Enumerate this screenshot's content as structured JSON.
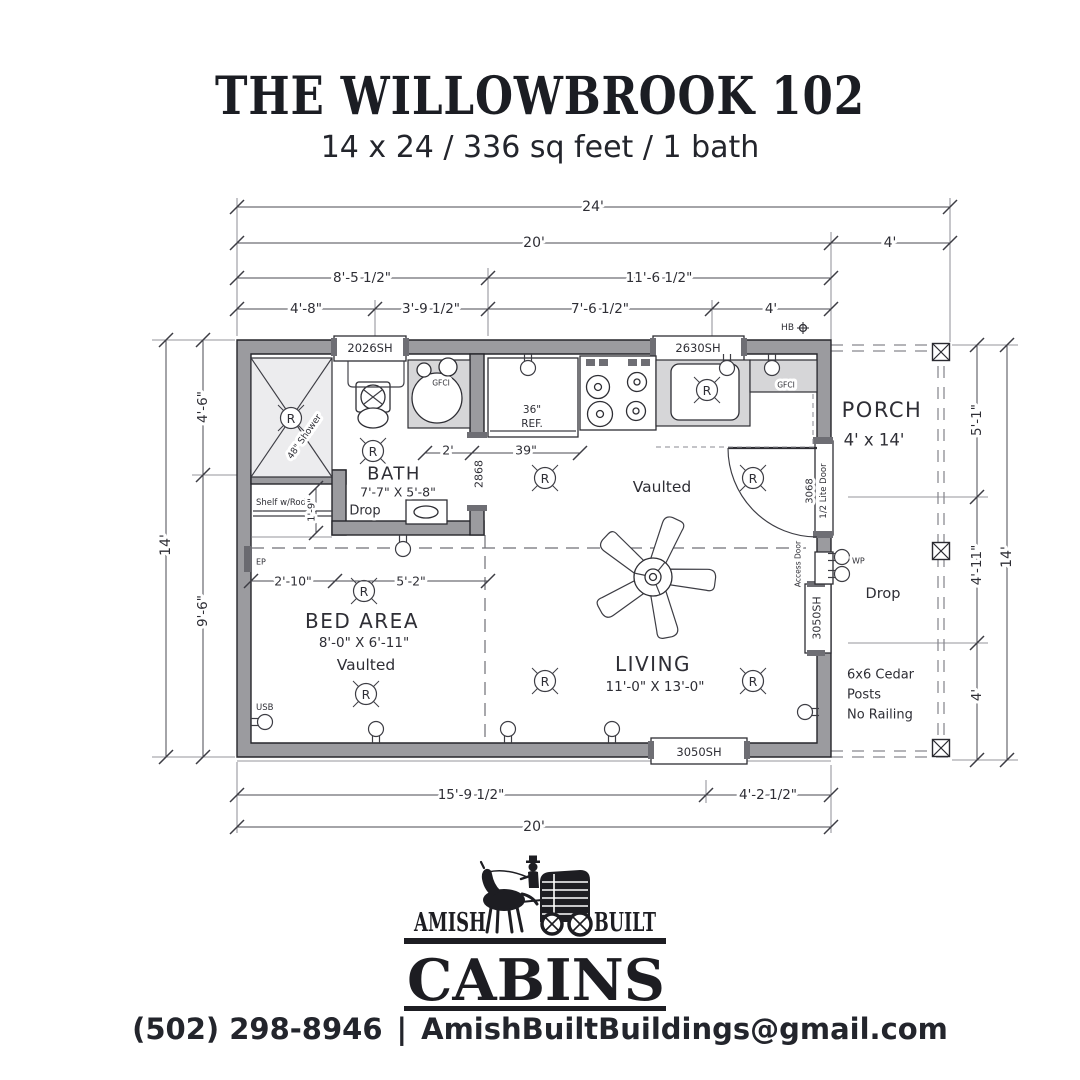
{
  "title": {
    "main": "THE WILLOWBROOK 102",
    "subtitle": "14 x 24 / 336 sq feet / 1 bath"
  },
  "plan": {
    "dims": {
      "w24": "24'",
      "w20": "20'",
      "w4": "4'",
      "w8_5": "8'-5 1/2\"",
      "w11_6": "11'-6 1/2\"",
      "w4_8": "4'-8\"",
      "w3_9": "3'-9 1/2\"",
      "w7_6": "7'-6 1/2\"",
      "w4b": "4'",
      "h4_6": "4'-6\"",
      "h14": "14'",
      "h9_6": "9'-6\"",
      "p5_1": "5'-1\"",
      "p4_11": "4'-11\"",
      "p4": "4'",
      "p14": "14'",
      "b15_9": "15'-9 1/2\"",
      "b4_2": "4'-2 1/2\"",
      "b20": "20'",
      "d2": "2'",
      "d39": "39\"",
      "d1_9": "1'-9\"",
      "d2_10": "2'-10\"",
      "d5_2": "5'-2\""
    },
    "openings": {
      "w2026": "2026SH",
      "w2630": "2630SH",
      "w3050_bottom": "3050SH",
      "w3050_side": "3050SH",
      "d2868": "2868",
      "d3068": "3068",
      "d3068_type": "1/2 Lite Door",
      "access": "Access Door"
    },
    "rooms": {
      "bath": {
        "name": "BATH",
        "size": "7'-7\" X 5'-8\"",
        "note": "Drop"
      },
      "bed": {
        "name": "BED AREA",
        "size": "8'-0\" X 6'-11\"",
        "note": "Vaulted"
      },
      "living": {
        "name": "LIVING",
        "size": "11'-0\" X 13'-0\""
      },
      "kitchen": {
        "note": "Vaulted"
      },
      "porch": {
        "name": "PORCH",
        "size": "4' x 14'",
        "note": "Drop",
        "posts_line1": "6x6 Cedar",
        "posts_line2": "Posts",
        "posts_line3": "No Railing"
      }
    },
    "labels": {
      "shower": "48\" Shower",
      "shelf": "Shelf w/Rod",
      "ref_width": "36\"",
      "ref": "REF.",
      "gfci": "GFCI",
      "hb": "HB",
      "wp": "WP",
      "ep": "EP",
      "usb": "USB",
      "r": "R"
    }
  },
  "logo": {
    "left": "AMISH",
    "right": "BUILT",
    "name": "CABINS"
  },
  "footer": {
    "phone": "(502) 298-8946",
    "divider": "|",
    "email": "AmishBuiltBuildings@gmail.com"
  },
  "colors": {
    "ink": "#22242b",
    "wall_fill": "#9b9b9f",
    "counter_fill": "#d6d6d8"
  }
}
